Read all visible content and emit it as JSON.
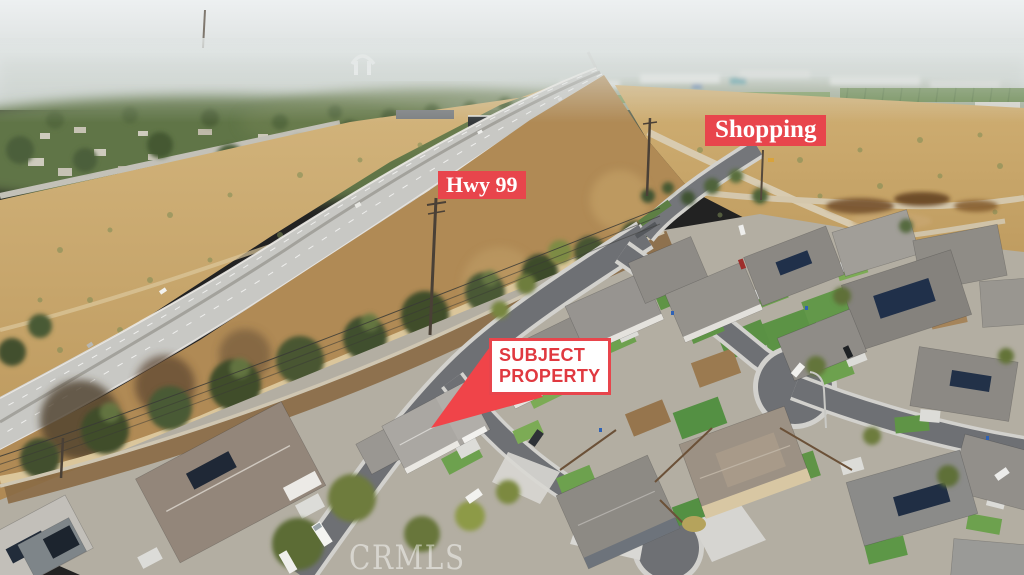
{
  "overlays": {
    "shopping_label": "Shopping",
    "highway_label": "Hwy 99",
    "subject_property_sign": {
      "line1": "SUBJECT",
      "line2": "PROPERTY"
    },
    "watermark": "CRMLS"
  },
  "colors": {
    "annotation_red": "#e8454c",
    "annotation_text": "#ffffff",
    "sign_background": "#ffffff",
    "sign_text_red": "#e03940",
    "arrow_red": "#f04449",
    "watermark_color": "rgba(255,255,255,0.48)"
  }
}
